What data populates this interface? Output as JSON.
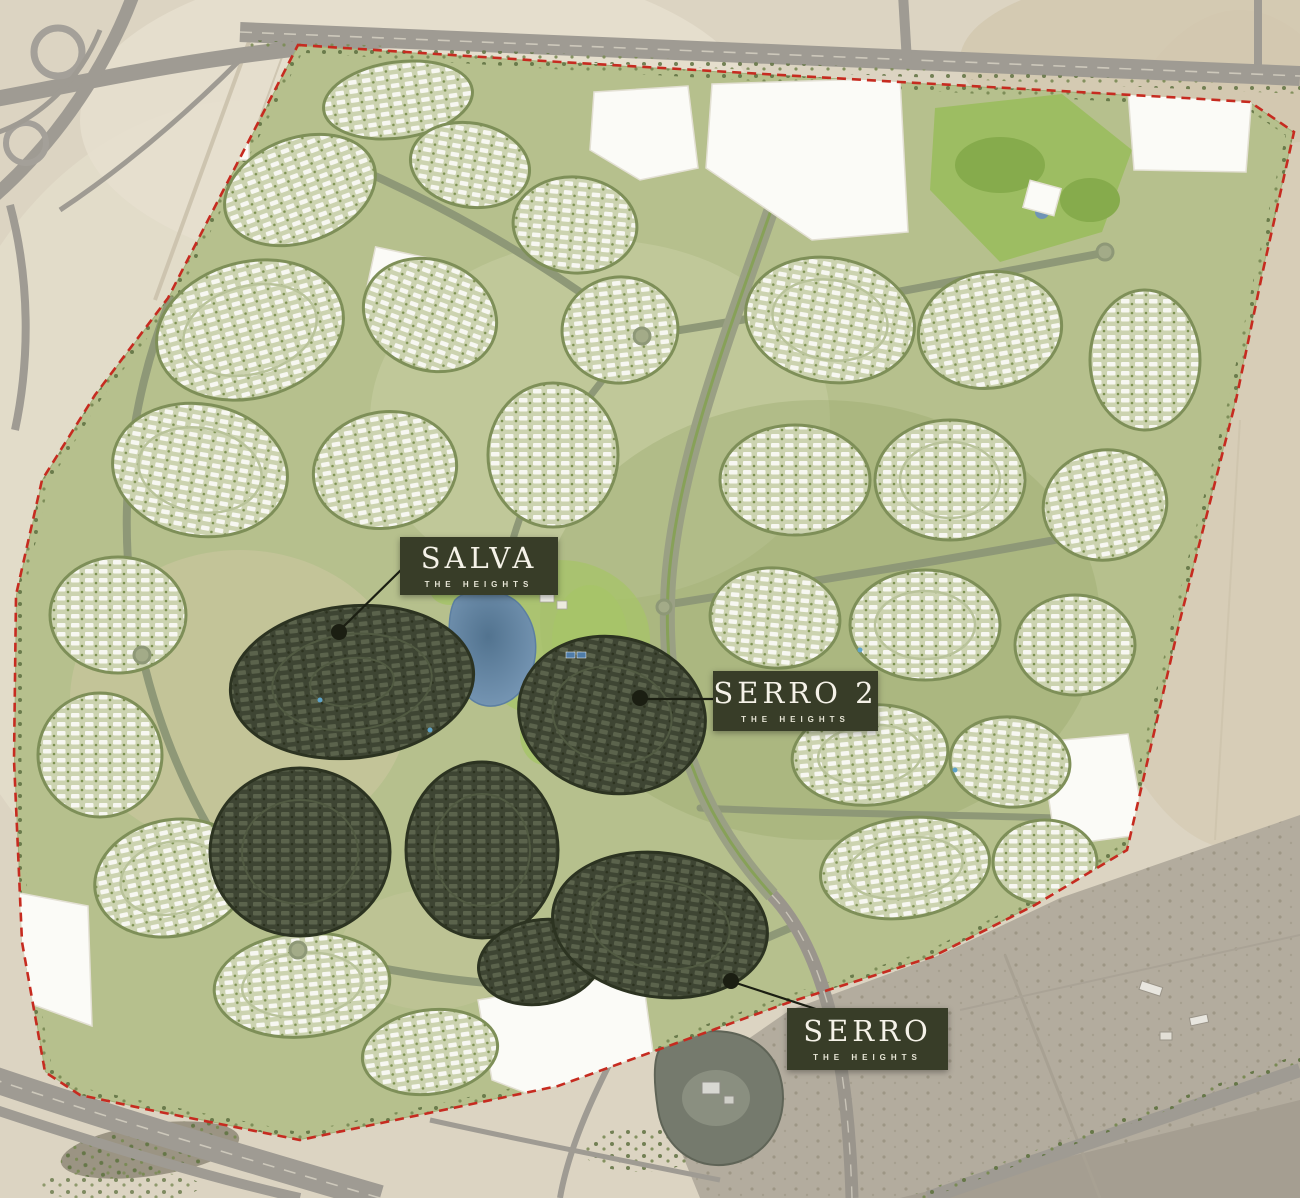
{
  "map": {
    "type": "masterplan-satellite",
    "development": "The Heights",
    "labels": [
      {
        "name": "SALVA",
        "sublabel": "THE HEIGHTS"
      },
      {
        "name": "SERRO 2",
        "sublabel": "THE HEIGHTS"
      },
      {
        "name": "SERRO",
        "sublabel": "THE HEIGHTS"
      }
    ],
    "colors": {
      "label_background": "#383d28",
      "label_text": "#f5f2e8",
      "label_subtext": "#e7e5d6",
      "boundary": "#c62b20",
      "leader": "#1b1e12",
      "highlight_community": "#3e4533",
      "standard_community": "#f4f5ee",
      "water": "#7193b3",
      "greenery": "#b6c08d",
      "desert": "#dcd4c2",
      "road": "#9f9b93"
    }
  }
}
